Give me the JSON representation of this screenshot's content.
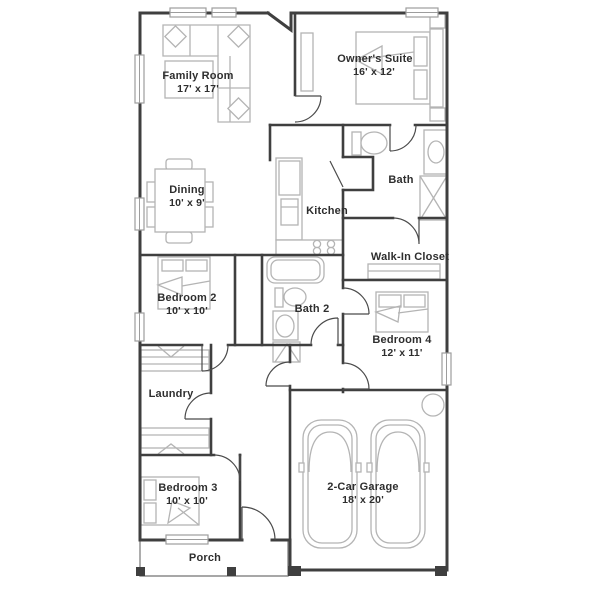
{
  "plan": {
    "type": "floor-plan",
    "colors": {
      "wall": "#3f3f3f",
      "furniture": "#b4b4b4",
      "text": "#2e2e2e",
      "background": "#ffffff"
    },
    "rooms": [
      {
        "name": "Family Room",
        "dimensions": "17' x 17'"
      },
      {
        "name": "Owner's Suite",
        "dimensions": "16' x 12'"
      },
      {
        "name": "Dining",
        "dimensions": "10' x 9'"
      },
      {
        "name": "Kitchen",
        "dimensions": ""
      },
      {
        "name": "Bath",
        "dimensions": ""
      },
      {
        "name": "Walk-In Closet",
        "dimensions": ""
      },
      {
        "name": "Bedroom 2",
        "dimensions": "10' x 10'"
      },
      {
        "name": "Bath 2",
        "dimensions": ""
      },
      {
        "name": "Bedroom 4",
        "dimensions": "12' x 11'"
      },
      {
        "name": "Laundry",
        "dimensions": ""
      },
      {
        "name": "Bedroom 3",
        "dimensions": "10' x 10'"
      },
      {
        "name": "2-Car Garage",
        "dimensions": "18' x 20'"
      },
      {
        "name": "Porch",
        "dimensions": ""
      }
    ]
  }
}
